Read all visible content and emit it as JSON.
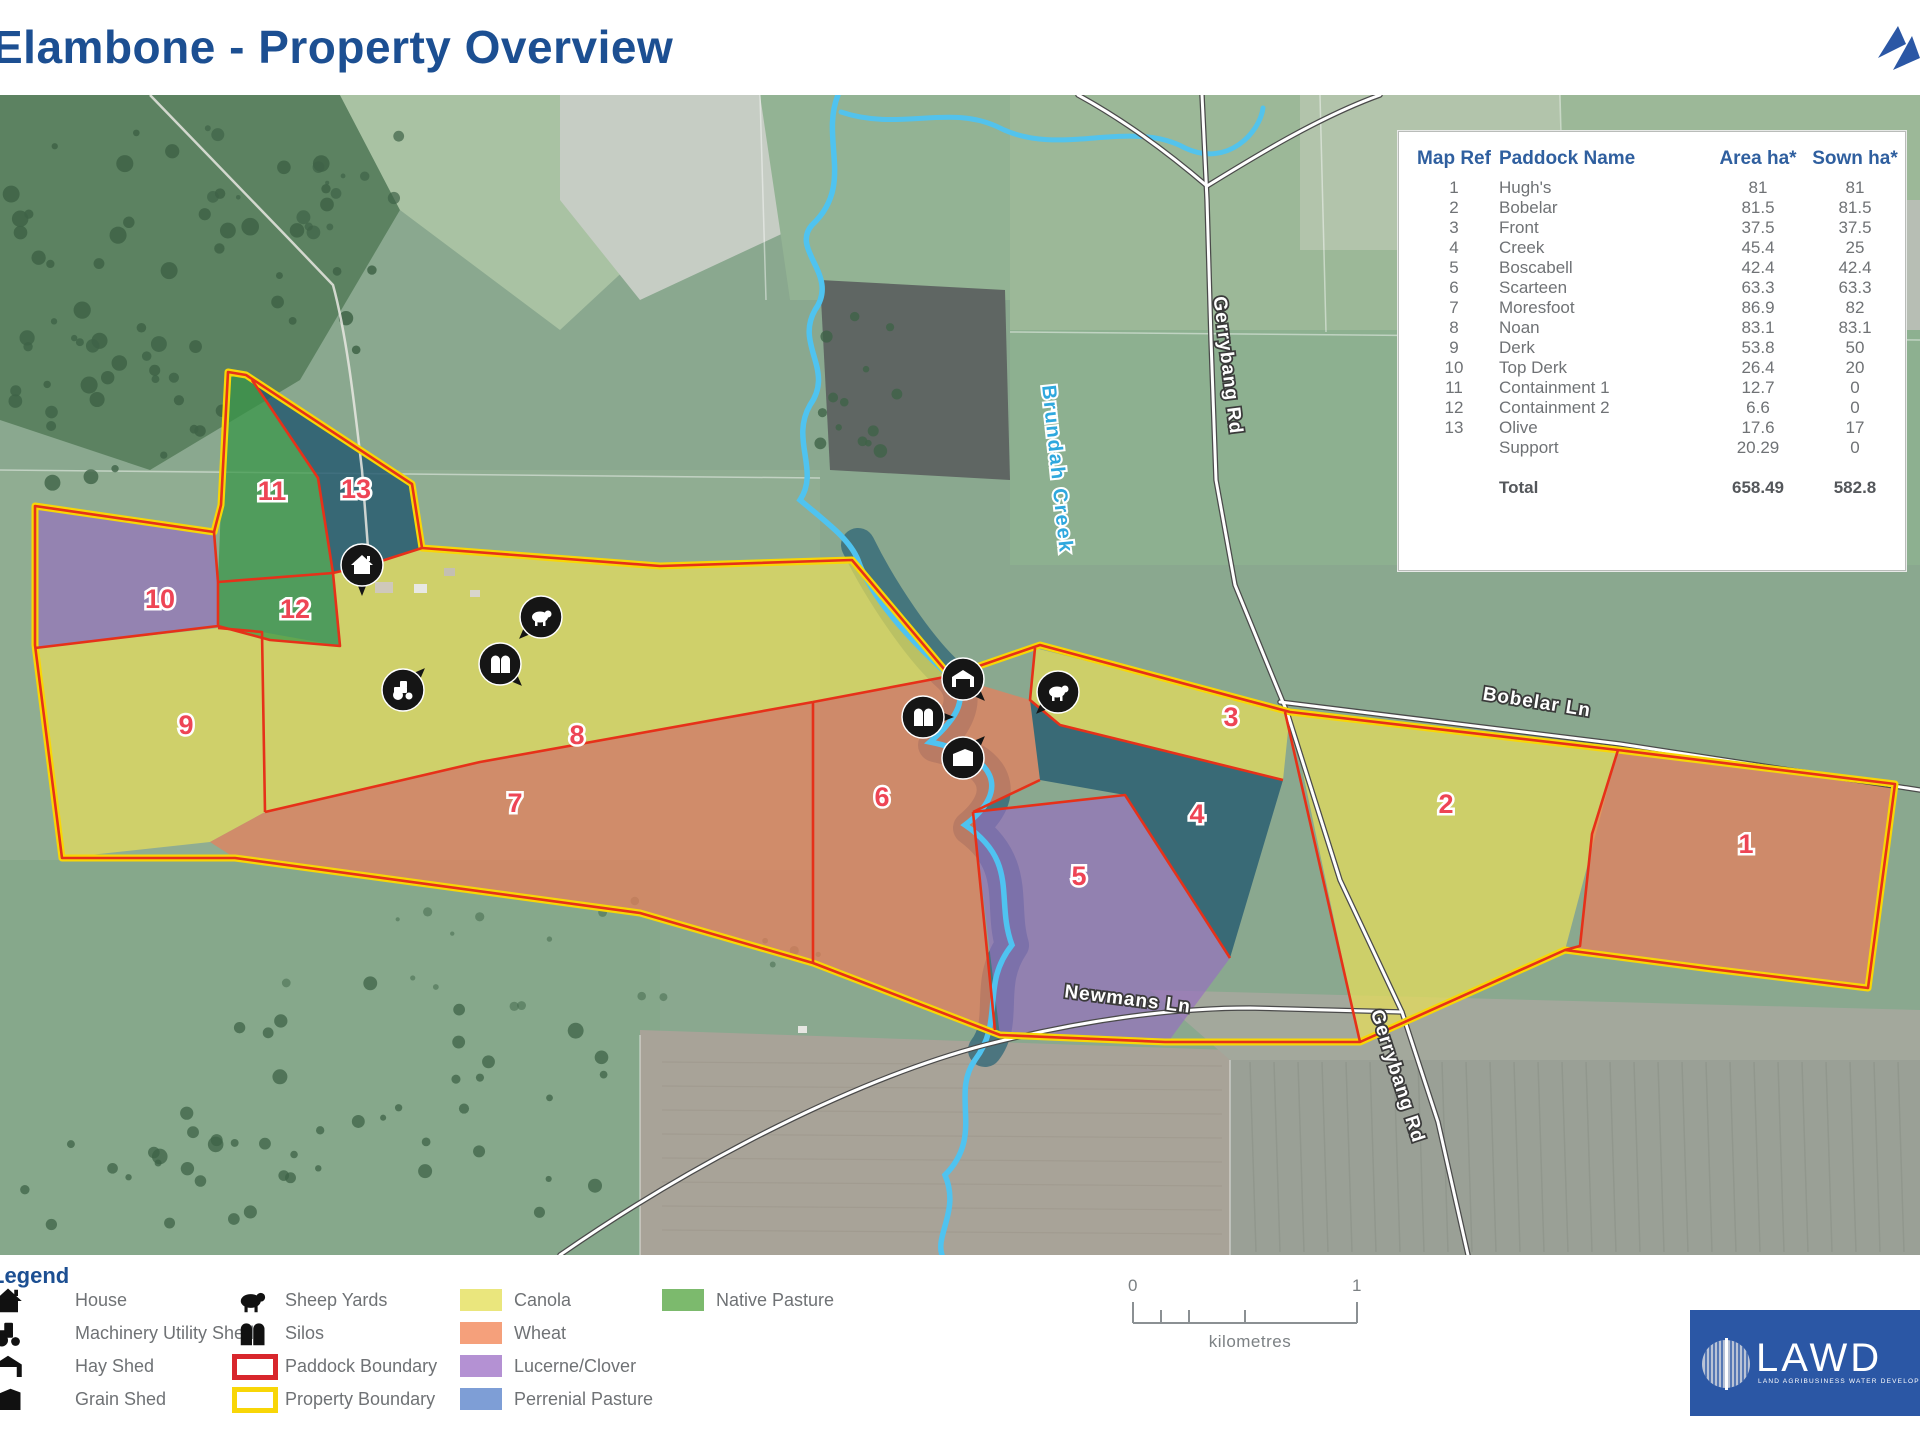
{
  "title": "Elambone - Property Overview",
  "colors": {
    "accent_blue": "#1c4f92",
    "table_header_blue": "#2f5f9f",
    "paddock_label_red": "#ee4555",
    "boundary_red": "#e63119",
    "property_yellow": "#f8d607",
    "creek_blue": "#4fc3f0",
    "canola": "#eae67d",
    "wheat": "#f5a07b",
    "lucerne": "#b491d3",
    "perennial_pasture": "#7e9ed6",
    "native_pasture": "#7cba6d",
    "lawd_blue": "#2b57a5"
  },
  "table": {
    "headers": [
      "Map Ref",
      "Paddock Name",
      "Area ha*",
      "Sown ha*"
    ],
    "rows": [
      {
        "ref": "1",
        "name": "Hugh's",
        "area": "81",
        "sown": "81"
      },
      {
        "ref": "2",
        "name": "Bobelar",
        "area": "81.5",
        "sown": "81.5"
      },
      {
        "ref": "3",
        "name": "Front",
        "area": "37.5",
        "sown": "37.5"
      },
      {
        "ref": "4",
        "name": "Creek",
        "area": "45.4",
        "sown": "25"
      },
      {
        "ref": "5",
        "name": "Boscabell",
        "area": "42.4",
        "sown": "42.4"
      },
      {
        "ref": "6",
        "name": "Scarteen",
        "area": "63.3",
        "sown": "63.3"
      },
      {
        "ref": "7",
        "name": "Moresfoot",
        "area": "86.9",
        "sown": "82"
      },
      {
        "ref": "8",
        "name": "Noan",
        "area": "83.1",
        "sown": "83.1"
      },
      {
        "ref": "9",
        "name": "Derk",
        "area": "53.8",
        "sown": "50"
      },
      {
        "ref": "10",
        "name": "Top Derk",
        "area": "26.4",
        "sown": "20"
      },
      {
        "ref": "11",
        "name": "Containment 1",
        "area": "12.7",
        "sown": "0"
      },
      {
        "ref": "12",
        "name": "Containment 2",
        "area": "6.6",
        "sown": "0"
      },
      {
        "ref": "13",
        "name": "Olive",
        "area": "17.6",
        "sown": "17"
      },
      {
        "ref": "",
        "name": "Support",
        "area": "20.29",
        "sown": "0"
      }
    ],
    "total": {
      "label": "Total",
      "area": "658.49",
      "sown": "582.8"
    }
  },
  "map": {
    "paddock_labels": [
      {
        "n": "1",
        "x": 1746,
        "y": 853
      },
      {
        "n": "2",
        "x": 1446,
        "y": 813
      },
      {
        "n": "3",
        "x": 1231,
        "y": 726
      },
      {
        "n": "4",
        "x": 1197,
        "y": 823
      },
      {
        "n": "5",
        "x": 1079,
        "y": 885
      },
      {
        "n": "6",
        "x": 882,
        "y": 806
      },
      {
        "n": "7",
        "x": 515,
        "y": 812
      },
      {
        "n": "8",
        "x": 577,
        "y": 744
      },
      {
        "n": "9",
        "x": 186,
        "y": 734
      },
      {
        "n": "10",
        "x": 160,
        "y": 608
      },
      {
        "n": "11",
        "x": 272,
        "y": 500
      },
      {
        "n": "12",
        "x": 295,
        "y": 618
      },
      {
        "n": "13",
        "x": 356,
        "y": 498
      }
    ],
    "road_labels": [
      {
        "id": "gerrybang-rd-top",
        "text": "Gerrybang Rd",
        "x": 1222,
        "y": 366,
        "rot": 83
      },
      {
        "id": "gerrybang-rd-bottom",
        "text": "Gerrybang Rd",
        "x": 1392,
        "y": 1078,
        "rot": 72
      },
      {
        "id": "bobelar-ln",
        "text": "Bobelar Ln",
        "x": 1536,
        "y": 708,
        "rot": 9
      },
      {
        "id": "newmans-ln",
        "text": "Newmans Ln",
        "x": 1127,
        "y": 1005,
        "rot": 7
      }
    ],
    "creek_label": {
      "text": "Brundah Creek",
      "x": 1051,
      "y": 470,
      "rot": 84
    },
    "markers": [
      {
        "icon": "house",
        "x": 362,
        "y": 565,
        "tail": 0
      },
      {
        "icon": "sheep",
        "x": 541,
        "y": 617,
        "tail": 45
      },
      {
        "icon": "silos",
        "x": 500,
        "y": 664,
        "tail": -45
      },
      {
        "icon": "machinery",
        "x": 403,
        "y": 690,
        "tail": -135
      },
      {
        "icon": "hay",
        "x": 963,
        "y": 679,
        "tail": -45
      },
      {
        "icon": "silos",
        "x": 923,
        "y": 717,
        "tail": -90
      },
      {
        "icon": "grain",
        "x": 963,
        "y": 758,
        "tail": -135
      },
      {
        "icon": "sheep",
        "x": 1058,
        "y": 692,
        "tail": 45
      }
    ]
  },
  "legend": {
    "title": "Legend",
    "buildings": [
      {
        "icon": "house",
        "label": "House"
      },
      {
        "icon": "machinery",
        "label": "Machinery Utility Shed"
      },
      {
        "icon": "hay",
        "label": "Hay Shed"
      },
      {
        "icon": "grain",
        "label": "Grain Shed"
      }
    ],
    "yards_boundaries": [
      {
        "icon": "sheep",
        "label": "Sheep Yards"
      },
      {
        "icon": "silos",
        "label": "Silos"
      },
      {
        "outline": "#d8262c",
        "label": "Paddock Boundary"
      },
      {
        "outline": "#f8d607",
        "label": "Property Boundary"
      }
    ],
    "crops": [
      {
        "color": "#eae67d",
        "label": "Canola"
      },
      {
        "color": "#f5a07b",
        "label": "Wheat"
      },
      {
        "color": "#b491d3",
        "label": "Lucerne/Clover"
      },
      {
        "color": "#7e9ed6",
        "label": "Perrenial Pasture"
      }
    ],
    "pasture": [
      {
        "color": "#7cba6d",
        "label": "Native Pasture"
      }
    ]
  },
  "scalebar": {
    "start": "0",
    "end": "1",
    "unit": "kilometres"
  },
  "logo": {
    "text": "LAWD",
    "tagline": "LAND AGRIBUSINESS WATER DEVELOPMENT"
  }
}
